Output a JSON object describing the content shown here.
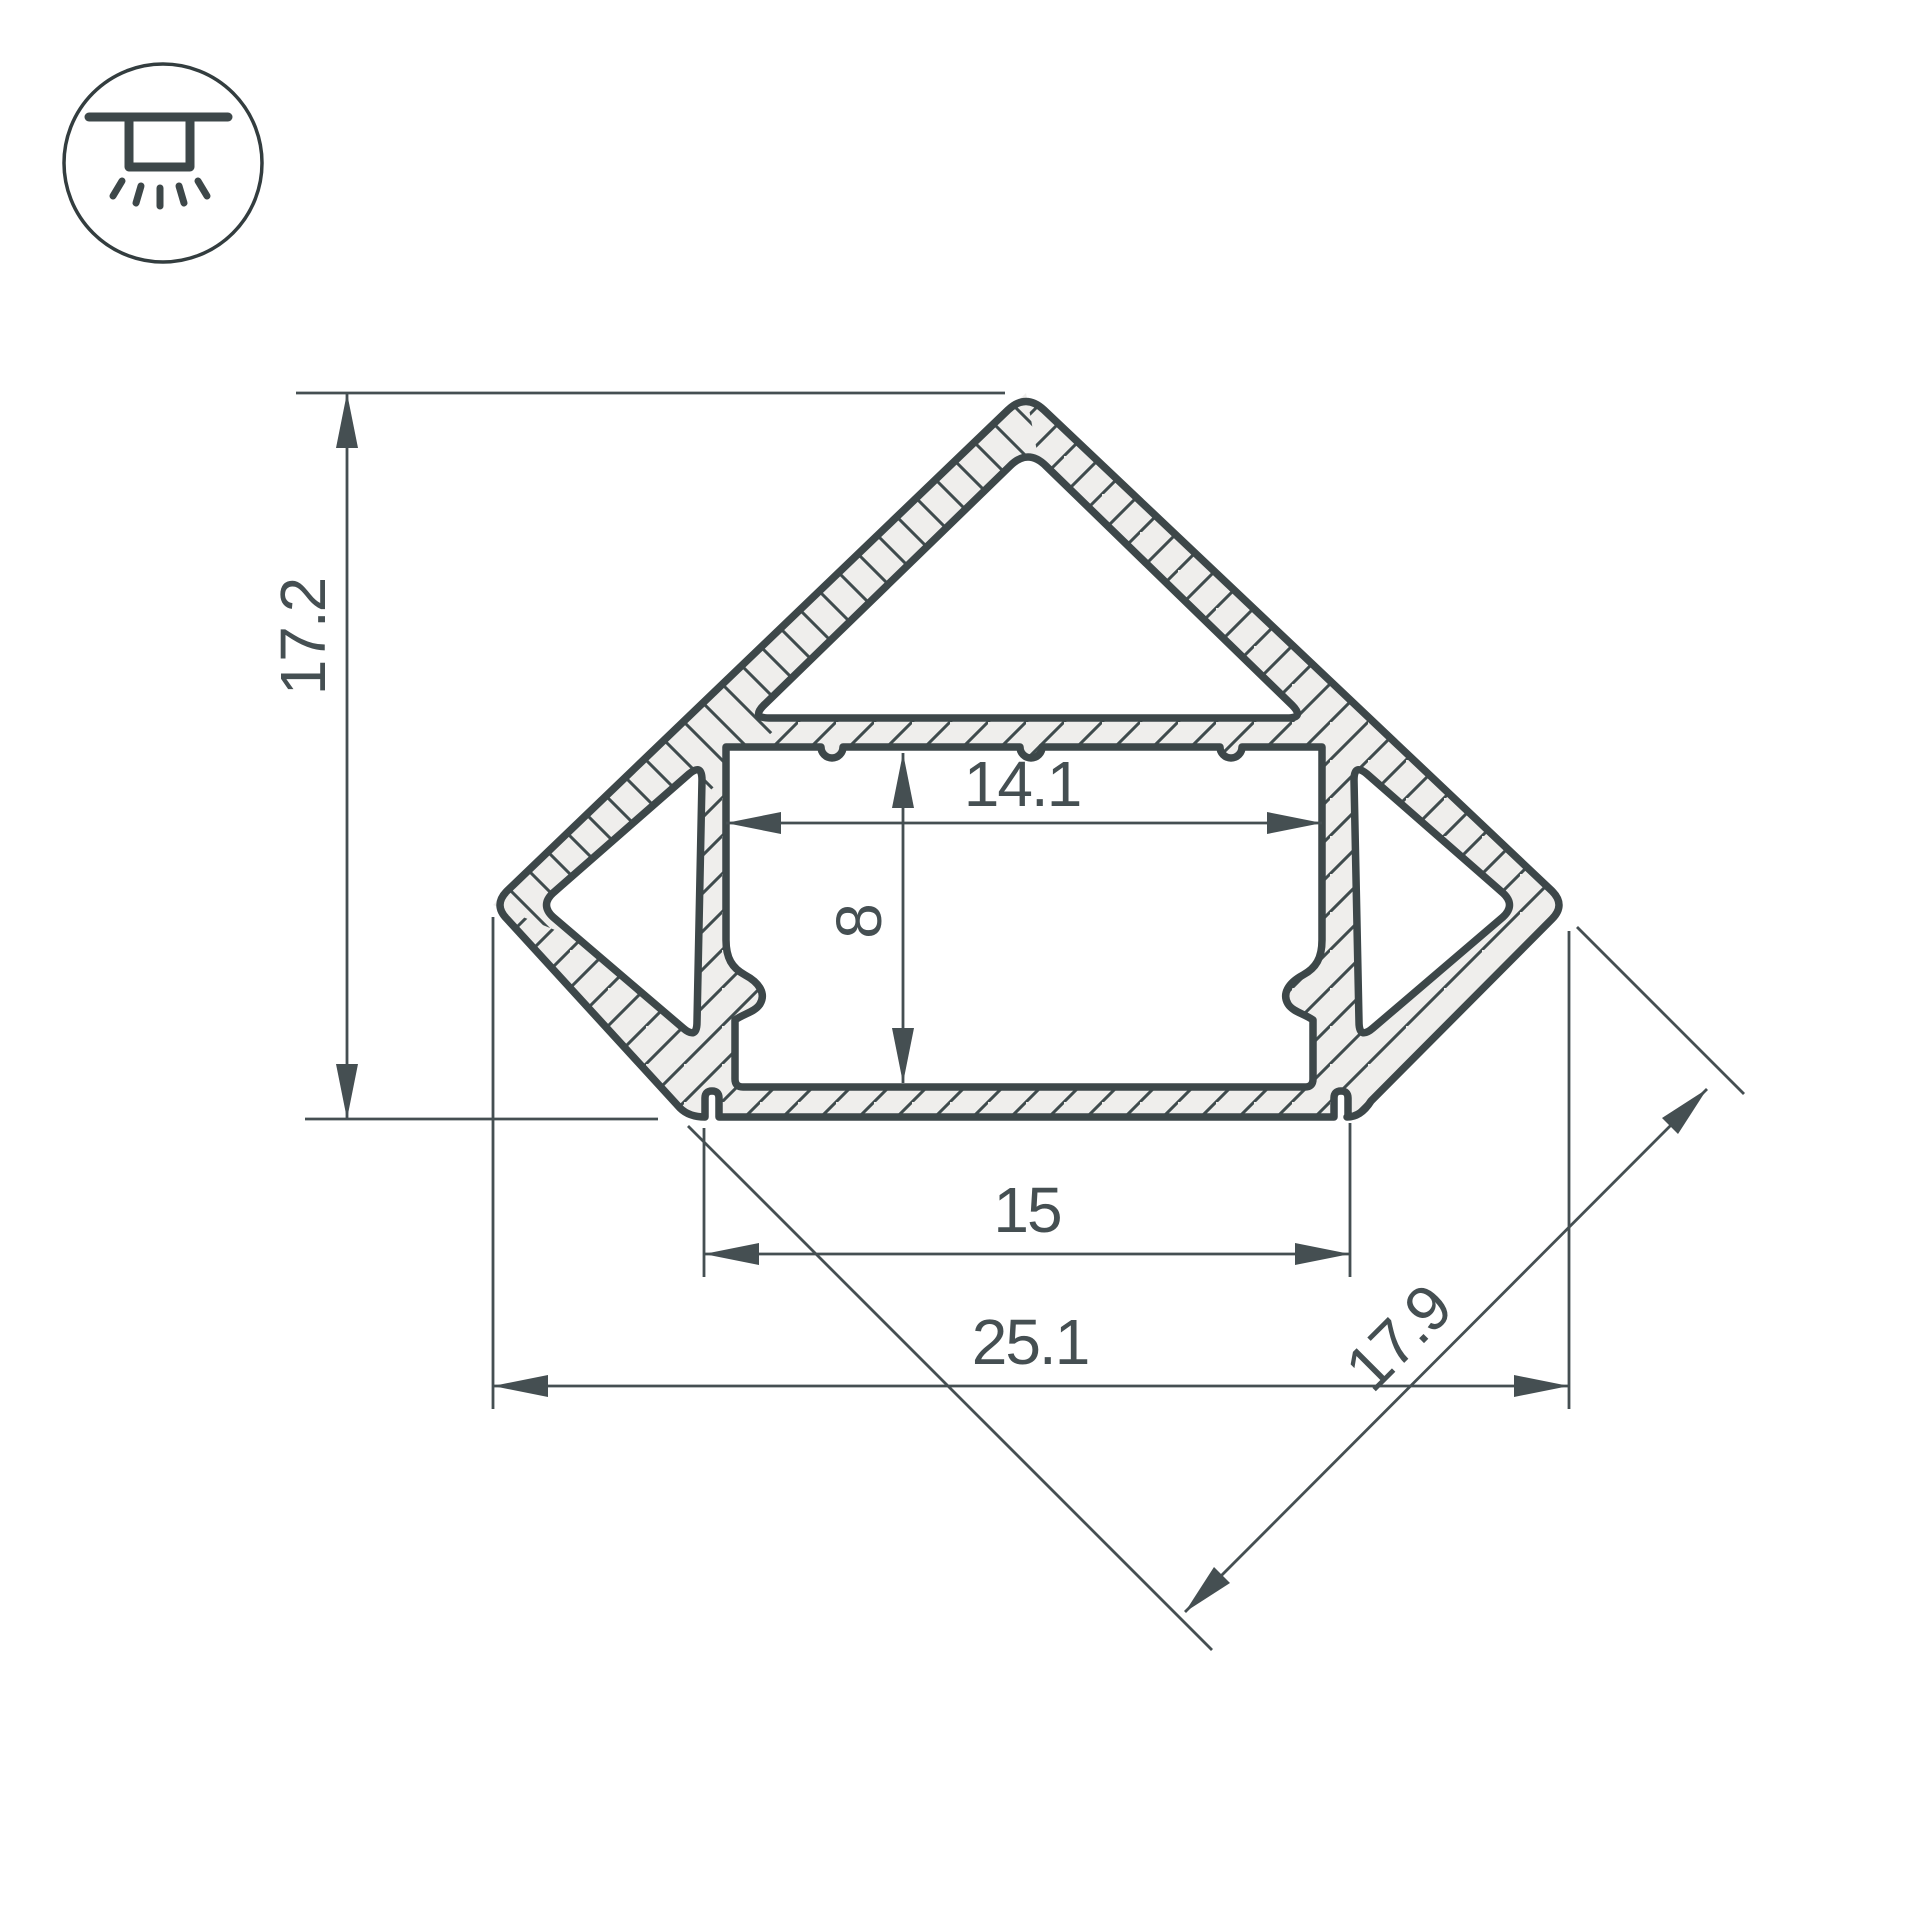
{
  "icon_badge": {
    "icon": "recessed-ceiling-light-icon"
  },
  "drawing": {
    "type": "technical-cross-section",
    "subject": "corner LED aluminum profile",
    "colors": {
      "line": "#3d4749",
      "wall_fill": "#efeeec",
      "cavity_fill": "#ffffff",
      "text": "#454f52",
      "background": "#ffffff"
    },
    "dimensions": {
      "overall_height": "17.2",
      "groove_width": "14.1",
      "groove_depth": "8",
      "base_width": "15",
      "overall_width": "25.1",
      "diagonal_side": "17.9"
    }
  }
}
